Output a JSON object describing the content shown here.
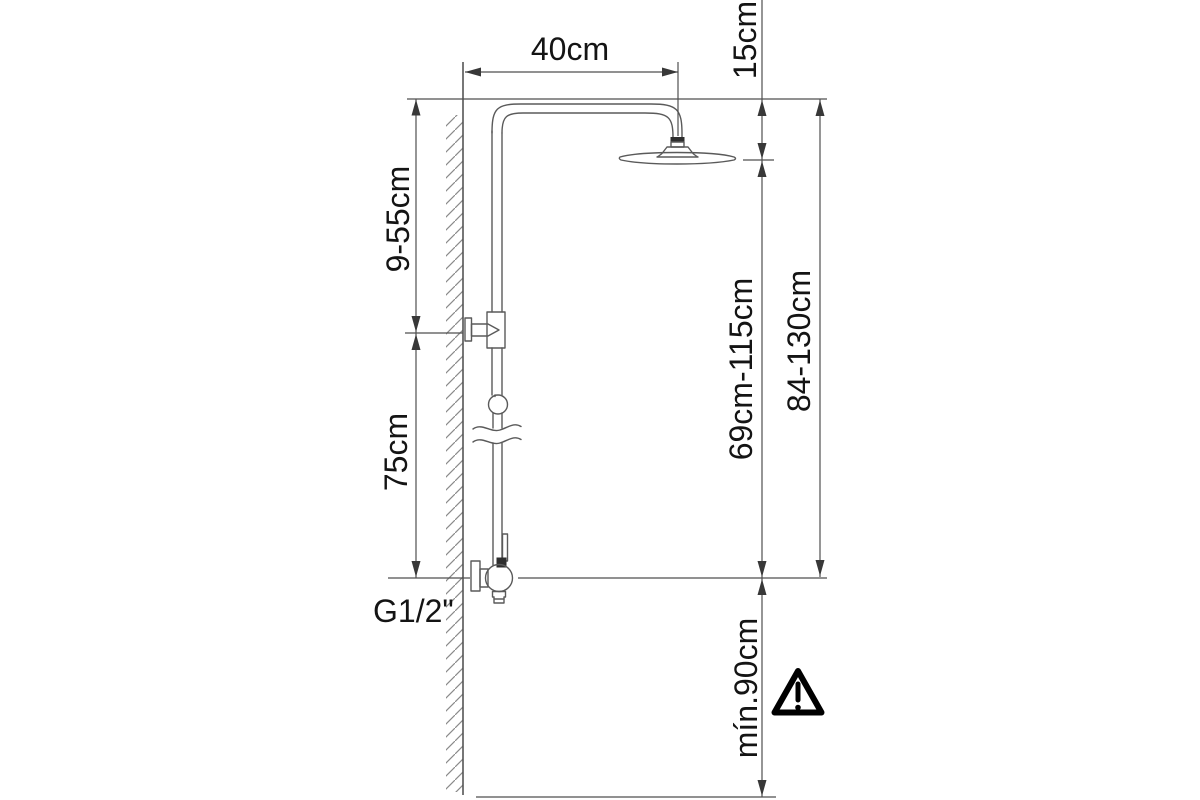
{
  "drawing": {
    "type": "installation-dimension-diagram",
    "subject": "wall-mounted shower column with overhead rain shower and mixer valve",
    "background_color": "#ffffff",
    "line_color": "#4f4f4f",
    "text_color": "#141414",
    "labels": {
      "arm_reach": "40cm",
      "head_offset": "15cm",
      "bracket_range": "9-55cm",
      "riser_length": "75cm",
      "outlet_to_head": "69cm-115cm",
      "overall_height": "84-130cm",
      "thread": "G1/2\"",
      "min_height": "mín.90cm"
    },
    "icons": {
      "warning": "caution-triangle"
    }
  }
}
